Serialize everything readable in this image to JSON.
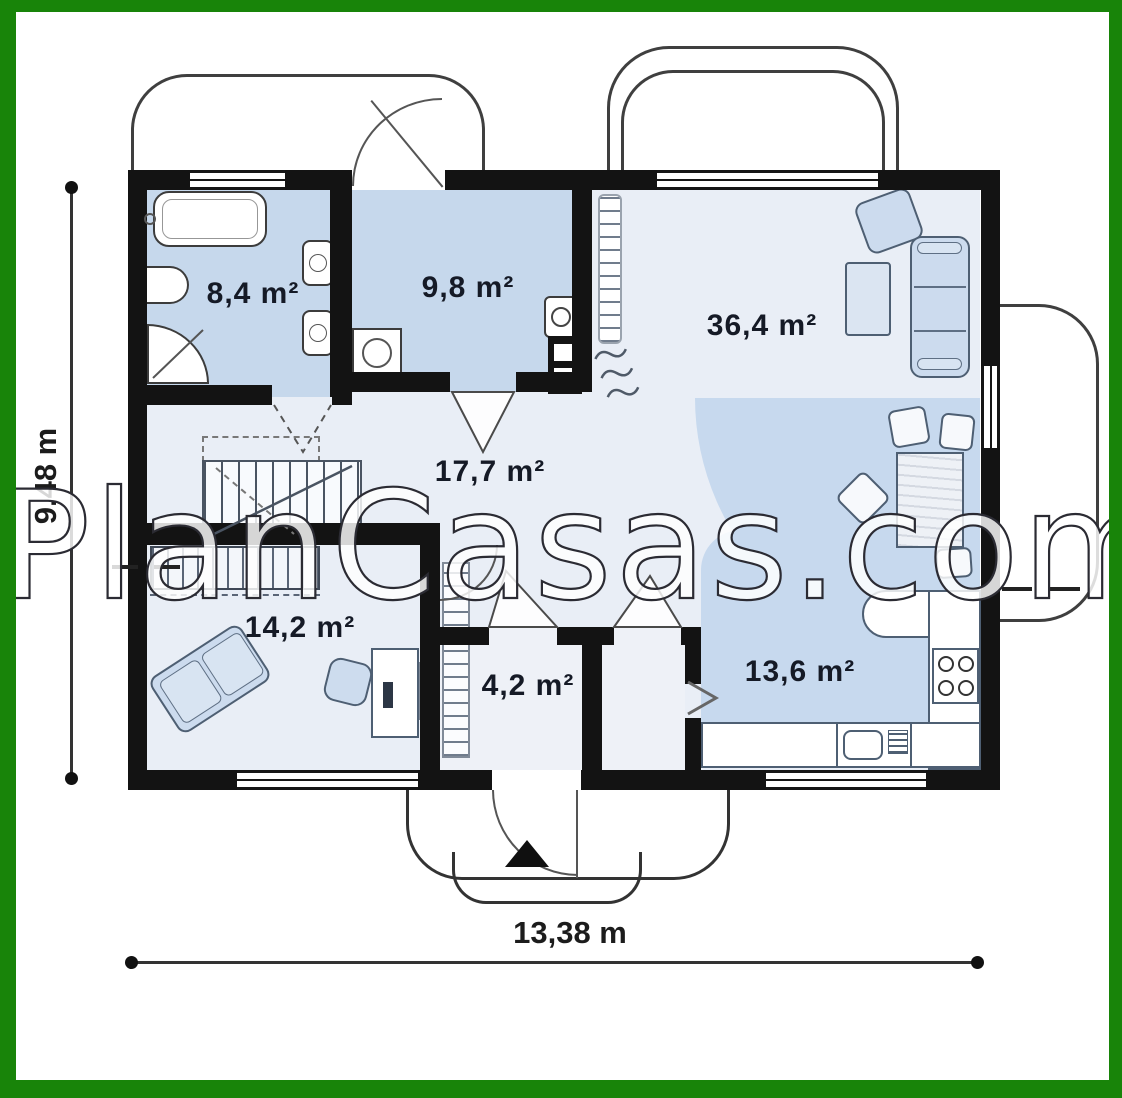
{
  "watermark": {
    "text": "PlanCasas.com"
  },
  "dimensions": {
    "height": {
      "label": "9,48 m"
    },
    "width": {
      "label": "13,38 m"
    }
  },
  "rooms": {
    "bathroom": {
      "label": "8,4 m²"
    },
    "utility": {
      "label": "9,8 m²"
    },
    "living": {
      "label": "36,4 m²"
    },
    "hall": {
      "label": "17,7 m²"
    },
    "bedroom": {
      "label": "14,2 m²"
    },
    "vestibule": {
      "label": "4,2 m²"
    },
    "kitchen": {
      "label": "13,6 m²"
    }
  },
  "colors": {
    "frame_green": "#188409",
    "wall_black": "#131313",
    "room_blue": "#c6d8ec",
    "floor_light": "#e9eef6",
    "furniture_blue": "#ccdbee",
    "furniture_outline": "#4e5f73"
  }
}
